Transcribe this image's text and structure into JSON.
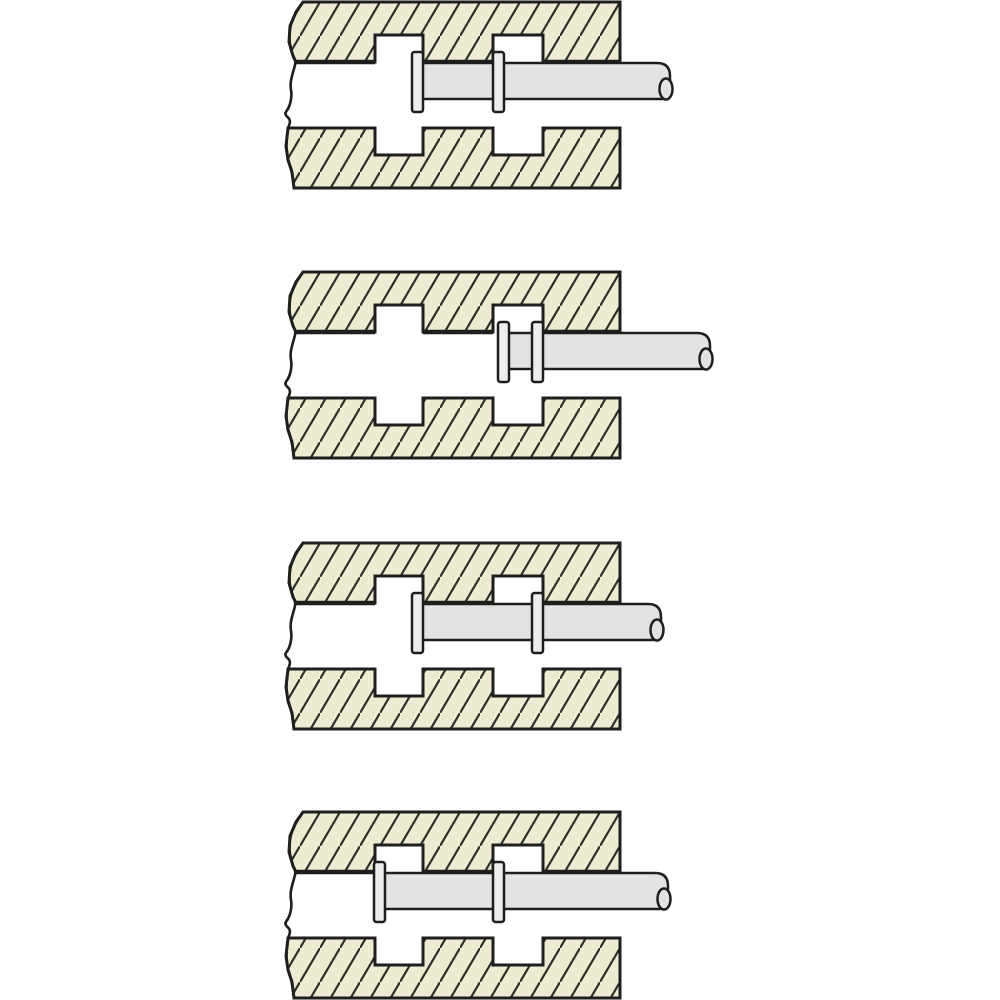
{
  "diagram": {
    "type": "technical-illustration",
    "subject": "slotted-channel-with-double-collar-pin-positions",
    "canvas": {
      "width": 1000,
      "height": 1000,
      "background": "#ffffff"
    },
    "colors": {
      "plate_fill": "#edecd2",
      "hatch_line": "#2e2e28",
      "outline": "#1e1e1c",
      "shaft_fill": "#e3e3e3",
      "collar_fill": "#ededed",
      "channel_fill": "#ffffff"
    },
    "strokes": {
      "outline_width": 3,
      "thick_edge_width": 4.5,
      "thin_width": 2.5,
      "break_line_width": 2.6,
      "hatch_width": 2.2
    },
    "hatch": {
      "spacing_x": 20,
      "cell_h": 34
    },
    "plates": {
      "right_x": 620,
      "top_plate_top": 0,
      "top_plate_bottom": 60,
      "channel_bottom": 126,
      "bottom_plate_bottom": 186,
      "top_notch_top": 33,
      "bottom_notch_bottom": 153,
      "notches": [
        {
          "x1": 375,
          "x2": 423
        },
        {
          "x1": 493,
          "x2": 543
        }
      ],
      "bottom_edge_segments": [
        [
          296,
          375
        ],
        [
          423,
          493
        ],
        [
          543,
          620
        ]
      ],
      "wavy_left_edge": [
        [
          303,
          0
        ],
        [
          296,
          10
        ],
        [
          290,
          24
        ],
        [
          289,
          40
        ],
        [
          293,
          54
        ],
        [
          296,
          60
        ],
        [
          293,
          70
        ],
        [
          290,
          82
        ],
        [
          292,
          94
        ],
        [
          289,
          106
        ],
        [
          284,
          112
        ],
        [
          291,
          118
        ],
        [
          288,
          126
        ],
        [
          286,
          144
        ],
        [
          288,
          158
        ],
        [
          292,
          170
        ],
        [
          294,
          186
        ]
      ]
    },
    "pin": {
      "shaft_top": 61,
      "shaft_bottom": 97,
      "tip_corner_radius": 13,
      "tip_ellipse": {
        "dx": -4,
        "cy": 87,
        "rx": 6.5,
        "ry": 10.5
      },
      "collar_top": 50,
      "collar_width": 11,
      "collar_height": 60,
      "collar_corner_radius": 2.5
    },
    "panels": [
      {
        "id": "position-1",
        "top_y": 2,
        "shaft_right_x": 670,
        "collar_x": [
          412,
          493
        ]
      },
      {
        "id": "position-2",
        "top_y": 272,
        "shaft_right_x": 710,
        "collar_x": [
          498,
          532
        ]
      },
      {
        "id": "position-3",
        "top_y": 543,
        "shaft_right_x": 661,
        "collar_x": [
          412,
          532
        ]
      },
      {
        "id": "position-4",
        "top_y": 812,
        "shaft_right_x": 668,
        "collar_x": [
          374,
          493
        ]
      }
    ]
  }
}
